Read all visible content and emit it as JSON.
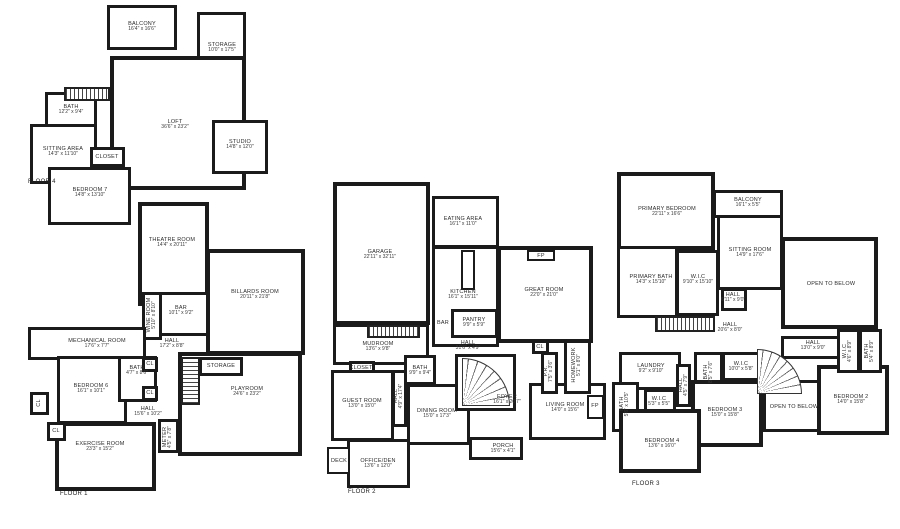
{
  "floor4": {
    "label": "FLOOR 4",
    "rooms": {
      "balcony": {
        "name": "BALCONY",
        "dims": "16'4\" x 16'6\""
      },
      "storage": {
        "name": "STORAGE",
        "dims": "10'0\" x 17'5\""
      },
      "loft": {
        "name": "LOFT",
        "dims": "36'6\" x 23'2\""
      },
      "bath": {
        "name": "BATH",
        "dims": "12'2\" x 9'4\""
      },
      "sitting": {
        "name": "SITTING AREA",
        "dims": "14'3\" x 11'10\""
      },
      "closet": {
        "name": "CLOSET"
      },
      "bedroom7": {
        "name": "BEDROOM 7",
        "dims": "14'8\" x 13'10\""
      },
      "studio": {
        "name": "STUDIO",
        "dims": "14'8\" x 12'0\""
      }
    }
  },
  "floor1": {
    "label": "FLOOR 1",
    "rooms": {
      "theatre": {
        "name": "THEATRE ROOM",
        "dims": "14'4\" x 20'11\""
      },
      "billards": {
        "name": "BILLARDS ROOM",
        "dims": "20'11\" x 21'8\""
      },
      "bar": {
        "name": "BAR",
        "dims": "10'1\" x 9'2\""
      },
      "wine": {
        "name": "WINE ROOM",
        "dims": "5'10\" x 8'10\""
      },
      "mechanical": {
        "name": "MECHANICAL ROOM",
        "dims": "17'6\" x 7'7\""
      },
      "hall_upper": {
        "name": "HALL",
        "dims": "17'2\" x 8'8\""
      },
      "bedroom6": {
        "name": "BEDROOM 6",
        "dims": "16'1\" x 10'1\""
      },
      "bath": {
        "name": "BATH",
        "dims": "4'7\" x 8'6\""
      },
      "storage": {
        "name": "STORAGE"
      },
      "playroom": {
        "name": "PLAYROOM",
        "dims": "24'6\" x 23'2\""
      },
      "hall_lower": {
        "name": "HALL",
        "dims": "15'6\" x 10'2\""
      },
      "meter": {
        "name": "METER",
        "dims": "4'5\" x 7'8\""
      },
      "exercise": {
        "name": "EXERCISE ROOM",
        "dims": "23'3\" x 15'2\""
      },
      "cl": {
        "name": "CL"
      }
    }
  },
  "floor2": {
    "label": "FLOOR 2",
    "rooms": {
      "garage": {
        "name": "GARAGE",
        "dims": "22'11\" x 32'11\""
      },
      "eating": {
        "name": "EATING AREA",
        "dims": "16'1\" x 11'0\""
      },
      "kitchen": {
        "name": "KITCHEN",
        "dims": "16'1\" x 15'11\""
      },
      "great": {
        "name": "GREAT ROOM",
        "dims": "22'0\" x 21'0\""
      },
      "fp": {
        "name": "FP"
      },
      "pantry": {
        "name": "PANTRY",
        "dims": "9'9\" x 5'9\""
      },
      "bar": {
        "name": "BAR"
      },
      "mudroom": {
        "name": "MUDROOM",
        "dims": "13'6\" x 9'8\""
      },
      "hall": {
        "name": "HALL",
        "dims": "31'6\" x 4'9\""
      },
      "closet": {
        "name": "CLOSET"
      },
      "bath": {
        "name": "BATH",
        "dims": "9'9\" x 9'4\""
      },
      "hall_v": {
        "name": "HALL",
        "dims": "4'9\" x 17'4\""
      },
      "guest": {
        "name": "GUEST ROOM",
        "dims": "13'0\" x 15'0\""
      },
      "dining": {
        "name": "DINING ROOM",
        "dims": "15'0\" x 17'3\""
      },
      "foyer": {
        "name": "FOYER",
        "dims": "16'1\" x 20'7\""
      },
      "living": {
        "name": "LIVING ROOM",
        "dims": "14'0\" x 15'6\""
      },
      "cl": {
        "name": "CL"
      },
      "pr": {
        "name": "P.R.",
        "dims": "7'5\" x 3'6\""
      },
      "homework": {
        "name": "HOMEWORK",
        "dims": "5'1\" x 8'0\""
      },
      "office": {
        "name": "OFFICE/DEN",
        "dims": "13'6\" x 12'0\""
      },
      "deck": {
        "name": "DECK"
      },
      "porch": {
        "name": "PORCH",
        "dims": "15'6\" x 4'1\""
      }
    }
  },
  "floor3": {
    "label": "FLOOR 3",
    "rooms": {
      "primary_bedroom": {
        "name": "PRIMARY BEDROOM",
        "dims": "22'11\" x 16'6\""
      },
      "balcony": {
        "name": "BALCONY",
        "dims": "16'1\" x 5'5\""
      },
      "sitting": {
        "name": "SITTING ROOM",
        "dims": "14'9\" x 17'6\""
      },
      "primary_bath": {
        "name": "PRIMARY BATH",
        "dims": "14'3\" x 15'10\""
      },
      "wic_main": {
        "name": "W.I.C",
        "dims": "9'10\" x 15'10\""
      },
      "hall_small": {
        "name": "HALL",
        "dims": "6'11\" x 9'0\""
      },
      "open_below": {
        "name": "OPEN TO BELOW"
      },
      "hall_upper": {
        "name": "HALL",
        "dims": "20'6\" x 8'0\""
      },
      "hall_right": {
        "name": "HALL",
        "dims": "13'0\" x 9'0\""
      },
      "laundry": {
        "name": "LAUNDRY",
        "dims": "9'2\" x 9'10\""
      },
      "bath_left": {
        "name": "BATH",
        "dims": "5'6\" x 10'5\""
      },
      "wic_small": {
        "name": "W.I.C",
        "dims": "5'3\" x 5'5\""
      },
      "hall_v": {
        "name": "HALL",
        "dims": "4'5\" x 7'9\""
      },
      "bath_mid": {
        "name": "BATH",
        "dims": "8'5\" x 7'6\""
      },
      "wic_mid": {
        "name": "W.I.C",
        "dims": "10'0\" x 5'8\""
      },
      "bedroom3": {
        "name": "BEDROOM 3",
        "dims": "15'0\" x 15'8\""
      },
      "bedroom4": {
        "name": "BEDROOM 4",
        "dims": "13'6\" x 16'0\""
      },
      "bedroom2": {
        "name": "BEDROOM 2",
        "dims": "14'0\" x 15'8\""
      },
      "wic_right": {
        "name": "W.I.C",
        "dims": "4'6\" x 8'9\""
      },
      "bath_right": {
        "name": "BATH",
        "dims": "5'4\" x 8'9\""
      }
    }
  }
}
